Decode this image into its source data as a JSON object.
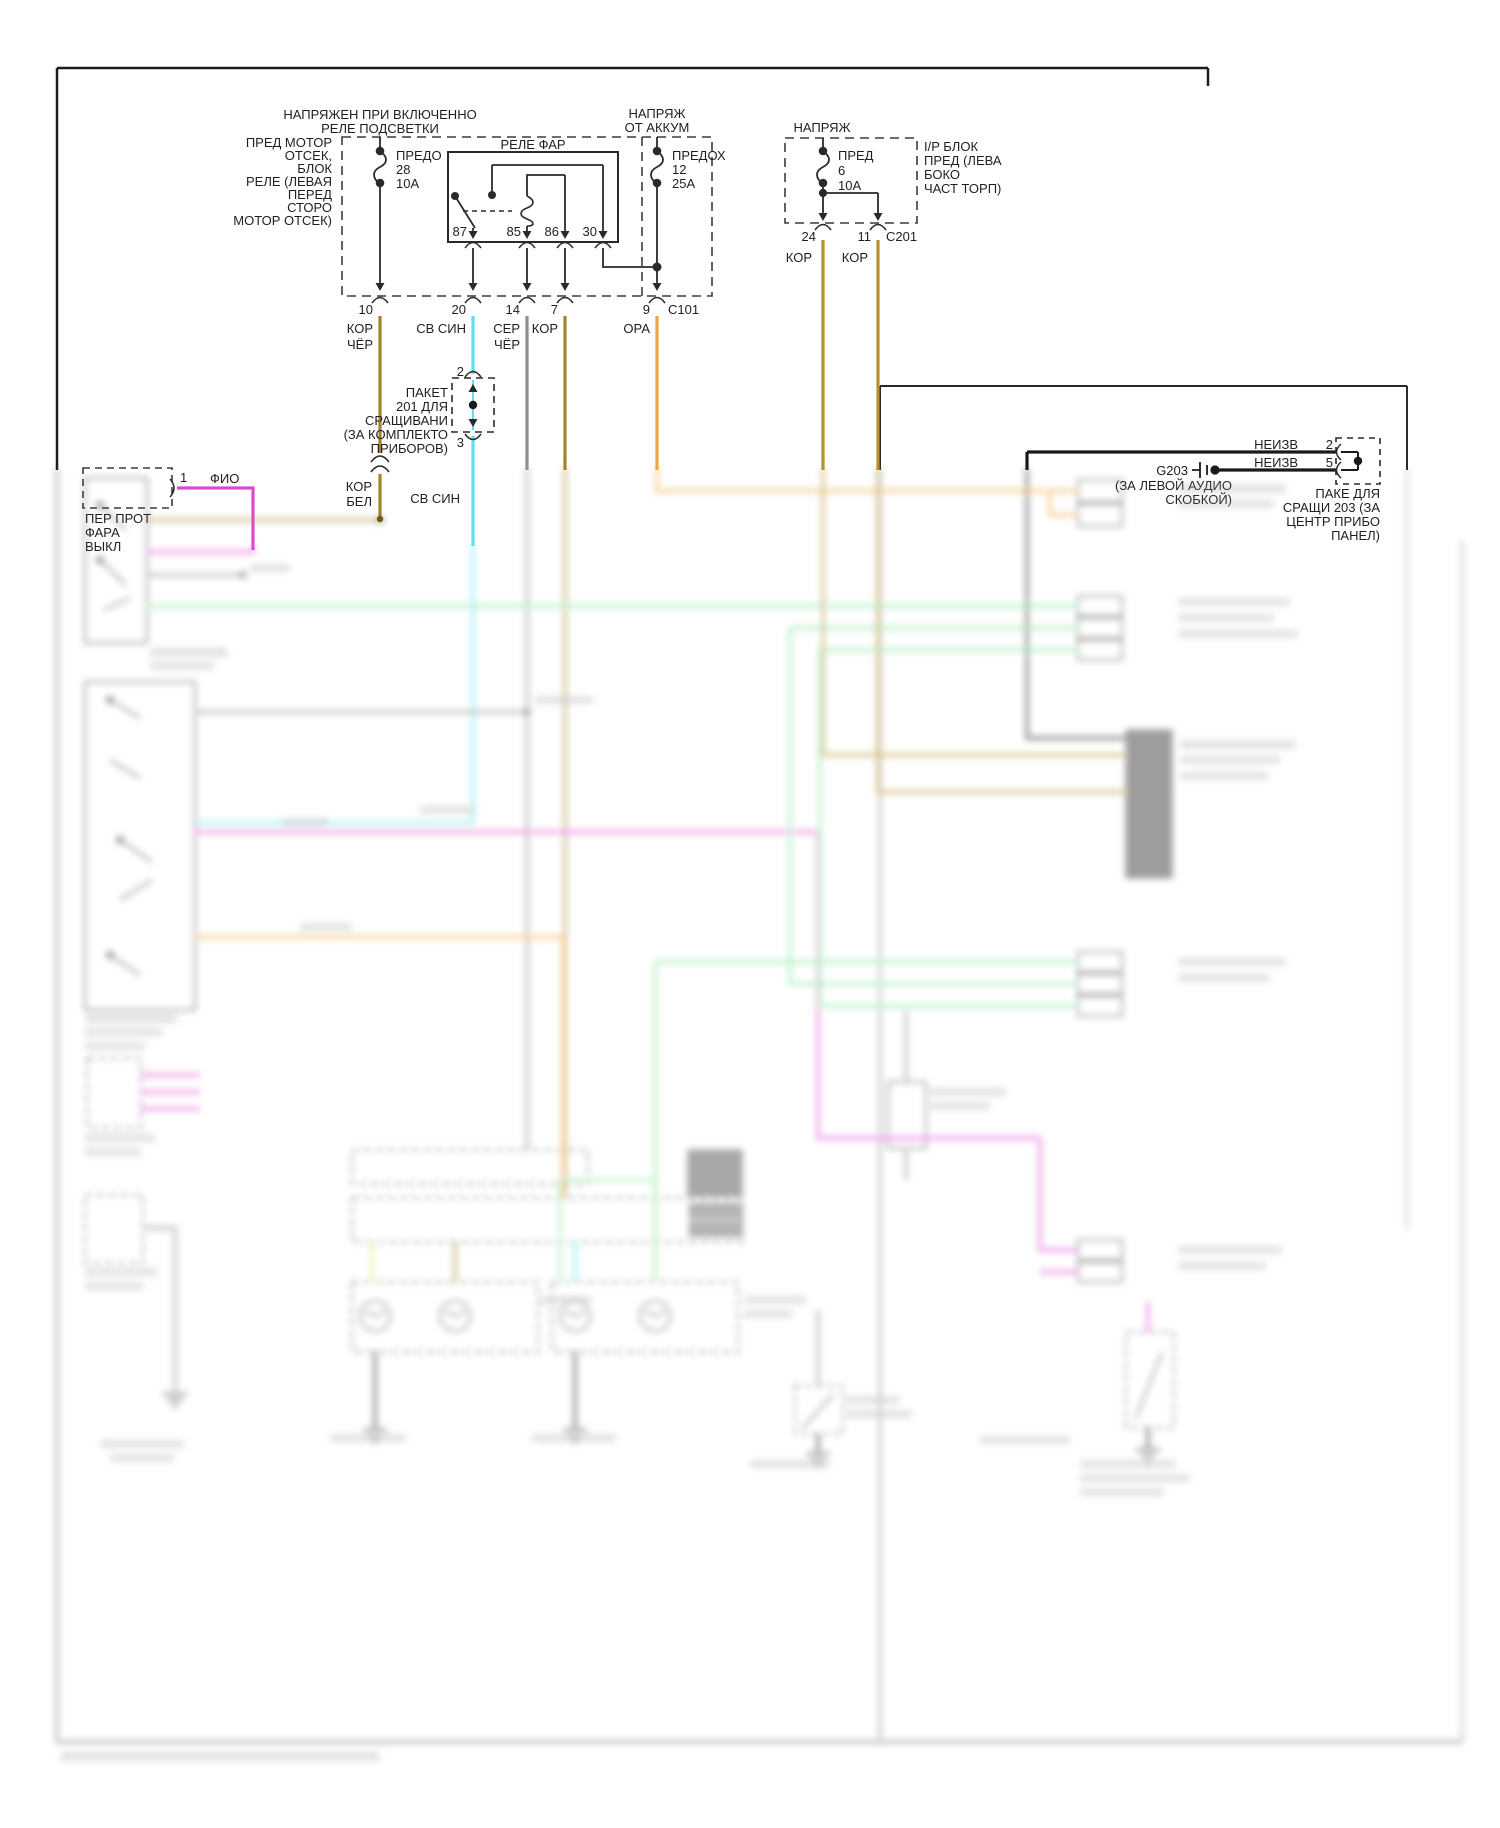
{
  "palette": {
    "line": "#3c3c3c",
    "wire_kor": "#a3842c",
    "wire_kor_gold": "#b3922e",
    "wire_sv_sin": "#5fe0ef",
    "wire_ser": "#8f8f8f",
    "wire_ora": "#efa63e",
    "wire_fio": "#dd4ad2",
    "wire_green": "#82e39b",
    "wire_yellow": "#e0e06a",
    "wire_black": "#1a1a1a"
  },
  "top": {
    "header_illum": [
      "НАПРЯЖЕН ПРИ ВКЛЮЧЕННО",
      "РЕЛЕ ПОДСВЕТКИ"
    ],
    "ufb_label": [
      "ПРЕД МОТОР",
      "ОТСЕК,",
      "БЛОК",
      "РЕЛЕ (ЛЕВАЯ",
      "ПЕРЕД",
      "СТОРО",
      "МОТОР ОТСЕК)"
    ],
    "fuse28": [
      "ПРЕДО",
      "28",
      "10А"
    ],
    "relay_title": "РЕЛЕ ФАР",
    "relay_pins": {
      "p87": "87",
      "p85": "85",
      "p86": "86",
      "p30": "30"
    },
    "header_batt": [
      "НАПРЯЖ",
      "ОТ АККУМ"
    ],
    "fuse12": [
      "ПРЕДОХ",
      "12",
      "25А"
    ],
    "header_ip": "НАПРЯЖ",
    "fuse6": [
      "ПРЕД",
      "6",
      "10А"
    ],
    "ip_label": [
      "I/P БЛОК",
      "ПРЕД (ЛЕВА",
      "БОКО",
      "ЧАСТ ТОРП)"
    ],
    "c101": "C101",
    "c201": "C201",
    "exit_pins": {
      "p10": "10",
      "p20": "20",
      "p14": "14",
      "p7": "7",
      "p9": "9"
    },
    "wire10": [
      "КОР",
      "ЧЁР"
    ],
    "wire20": "СВ СИН",
    "wire14": [
      "СЕР",
      "ЧЁР"
    ],
    "wire7": "КОР",
    "wire9": "ОРА",
    "pin24": "24",
    "pin11": "11",
    "kor24": "КОР",
    "kor11": "КОР",
    "splice201_label": [
      "ПАКЕТ",
      "201 ДЛЯ",
      "СРАЩИВАНИ",
      "(ЗА КОМПЛЕКТО",
      "ПРИБОРОВ)"
    ],
    "splice201_pin_top": "2",
    "splice201_pin_bottom": "3",
    "wire_korbel": [
      "КОР",
      "БЕЛ"
    ],
    "wire_svsin2": "СВ СИН",
    "fog_switch": {
      "pin": "1",
      "wire": "ФИО",
      "label": [
        "ПЕР ПРОТ",
        "ФАРА",
        "ВЫКЛ"
      ]
    },
    "g203": {
      "name": "G203",
      "label": [
        "(ЗА ЛЕВОЙ АУДИО",
        "СКОБКОЙ)"
      ]
    },
    "neizv2": {
      "label": "НЕИЗВ",
      "pin": "2"
    },
    "neizv5": {
      "label": "НЕИЗВ",
      "pin": "5"
    },
    "splice203_label": [
      "ПАКЕ ДЛЯ",
      "СРАЩИ 203 (ЗА",
      "ЦЕНТР ПРИБО",
      "ПАНЕЛ)"
    ]
  }
}
